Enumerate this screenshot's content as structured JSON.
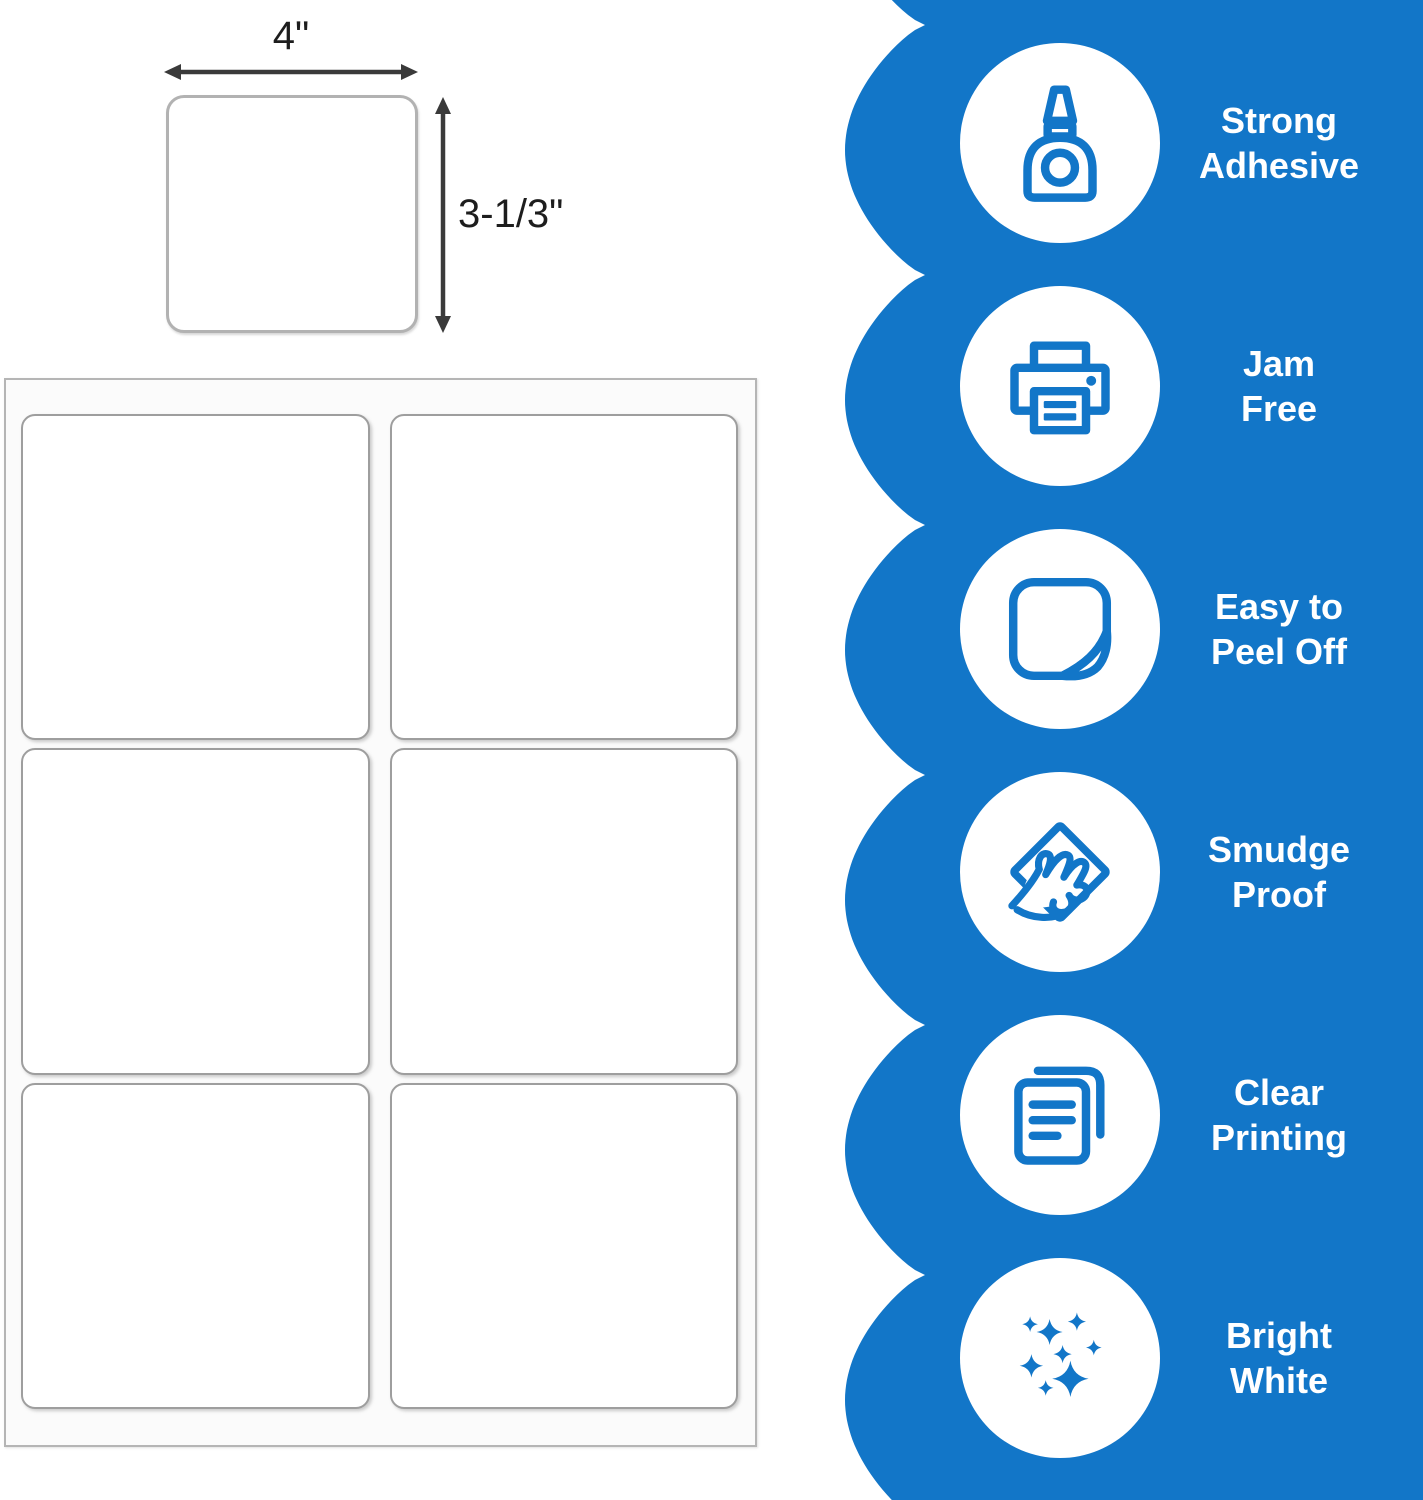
{
  "diagram": {
    "width_label": "4\"",
    "height_label": "3-1/3\""
  },
  "sheet": {
    "rows": 3,
    "columns": 2,
    "label_count": 6
  },
  "features": [
    {
      "icon": "glue-bottle-icon",
      "line1": "Strong",
      "line2": "Adhesive"
    },
    {
      "icon": "printer-icon",
      "line1": "Jam",
      "line2": "Free"
    },
    {
      "icon": "peel-sticker-icon",
      "line1": "Easy to",
      "line2": "Peel Off"
    },
    {
      "icon": "smudge-hand-icon",
      "line1": "Smudge",
      "line2": "Proof"
    },
    {
      "icon": "documents-icon",
      "line1": "Clear",
      "line2": "Printing"
    },
    {
      "icon": "sparkles-icon",
      "line1": "Bright",
      "line2": "White"
    }
  ],
  "colors": {
    "panel_blue": "#1276c8",
    "icon_blue": "#1276c8",
    "arrow_gray": "#3a3a3a",
    "label_border": "#9e9e9e",
    "sheet_border": "#b5b5b5",
    "text_white": "#ffffff"
  }
}
